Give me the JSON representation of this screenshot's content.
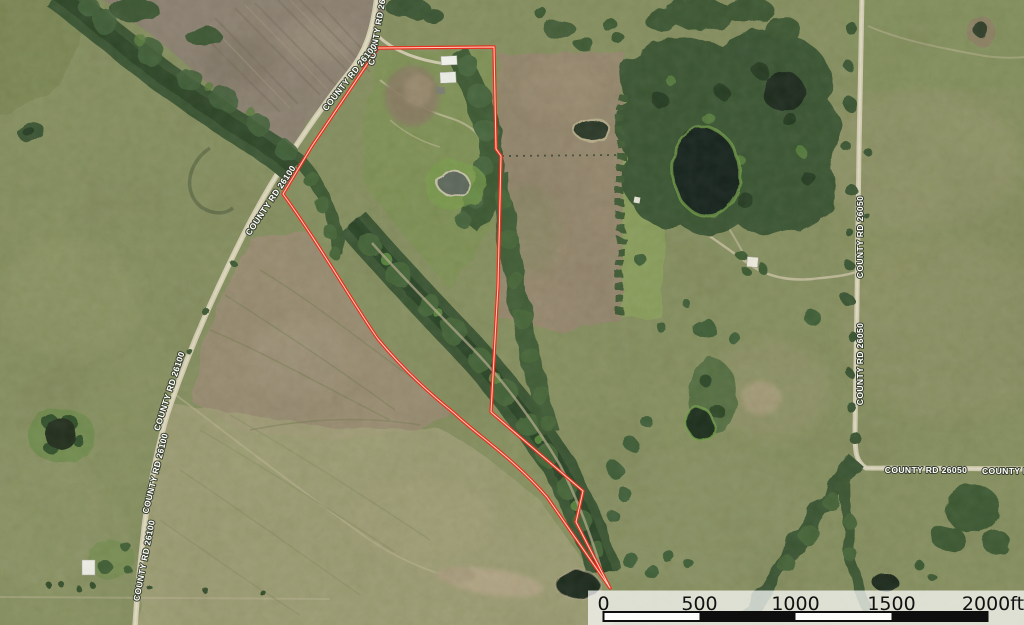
{
  "map": {
    "imagery_type": "satellite",
    "parcel_boundary": {
      "color": "#e8301f",
      "casing_color": "#ffe6d2"
    },
    "roads": {
      "county_rd_26100": {
        "name": "COUNTY RD 26100"
      },
      "county_rd_26050": {
        "name": "COUNTY RD 26050"
      }
    },
    "label_style": {
      "text_color": "#ffffff",
      "halo_color": "#38402e"
    },
    "scale_bar": {
      "ticks": [
        "0",
        "500",
        "1000",
        "1500",
        "2000ft"
      ],
      "segment_feet": 500,
      "max_feet": 2000,
      "bar_colors": [
        "#ffffff",
        "#111111"
      ]
    }
  }
}
